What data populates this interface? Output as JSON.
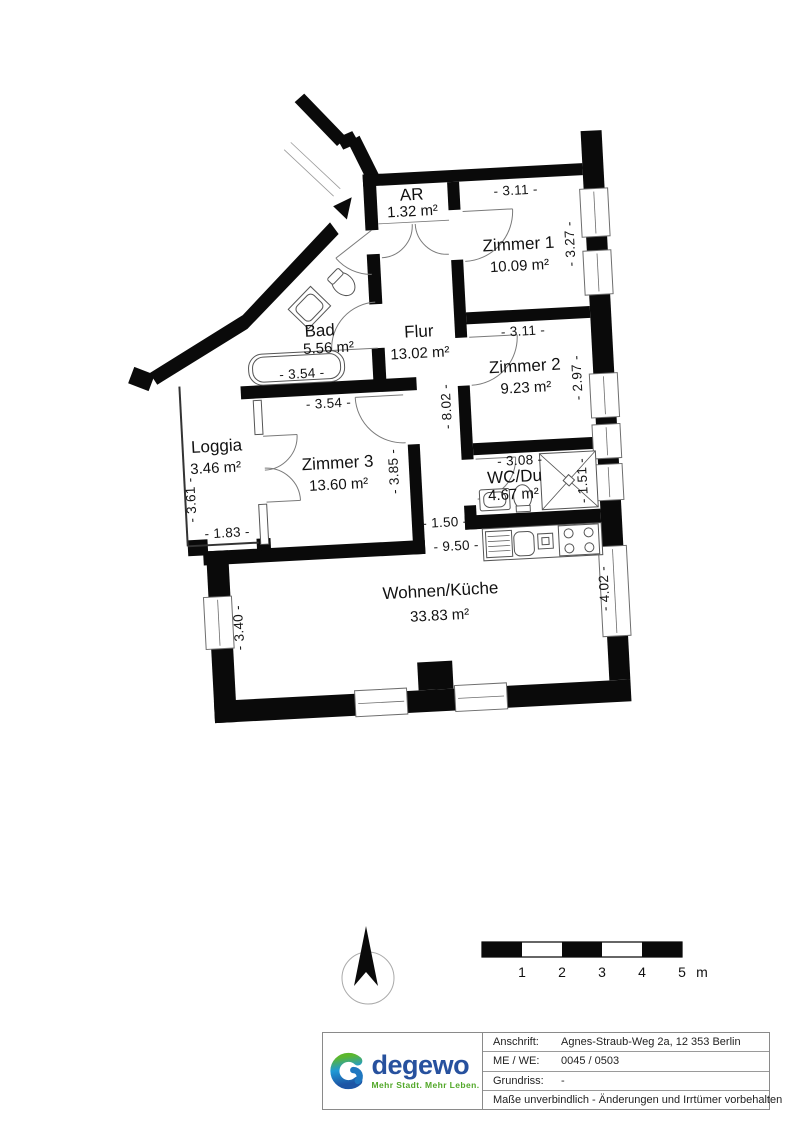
{
  "plan": {
    "rooms": [
      {
        "name": "AR",
        "area": "1.32 m²"
      },
      {
        "name": "Zimmer 1",
        "area": "10.09 m²"
      },
      {
        "name": "Zimmer 2",
        "area": "9.23 m²"
      },
      {
        "name": "WC/Du",
        "area": "4.67 m²"
      },
      {
        "name": "Flur",
        "area": "13.02 m²"
      },
      {
        "name": "Bad",
        "area": "5.56 m²"
      },
      {
        "name": "Zimmer 3",
        "area": "13.60 m²"
      },
      {
        "name": "Loggia",
        "area": "3.46 m²"
      },
      {
        "name": "Wohnen/Küche",
        "area": "33.83 m²"
      }
    ],
    "dimensions": {
      "z1_top": "- 3.11 -",
      "z1_right": "- 3.27 -",
      "z2_top": "- 3.11 -",
      "z2_right": "- 2.97 -",
      "wc_top": "- 3.08 -",
      "wc_right": "- 1.51 -",
      "flur": "- 8.02 -",
      "bad": "- 3.54 -",
      "z3_top": "- 3.54 -",
      "z3_right": "- 3.85 -",
      "loggia_left": "- 3.61 -",
      "loggia_bottom": "- 1.83 -",
      "passage": "- 1.50 -",
      "wohnen_top": "- 9.50 -",
      "wohnen_left": "- 3.40 -",
      "wohnen_right": "- 4.02 -"
    }
  },
  "scale_bar": {
    "labels": [
      "1",
      "2",
      "3",
      "4",
      "5"
    ],
    "unit": "m"
  },
  "title_block": {
    "rows": [
      {
        "label": "Anschrift:",
        "value": "Agnes-Straub-Weg 2a,  12 353  Berlin"
      },
      {
        "label": "ME / WE:",
        "value": "0045 / 0503"
      },
      {
        "label": "Grundriss:",
        "value": "-"
      }
    ],
    "disclaimer": "Maße unverbindlich - Änderungen und Irrtümer vorbehalten",
    "logo": {
      "name": "degewo",
      "tagline": "Mehr Stadt. Mehr Leben."
    }
  },
  "colors": {
    "wall": "#000000",
    "brand_blue": "#27519e",
    "brand_green": "#52a829"
  }
}
